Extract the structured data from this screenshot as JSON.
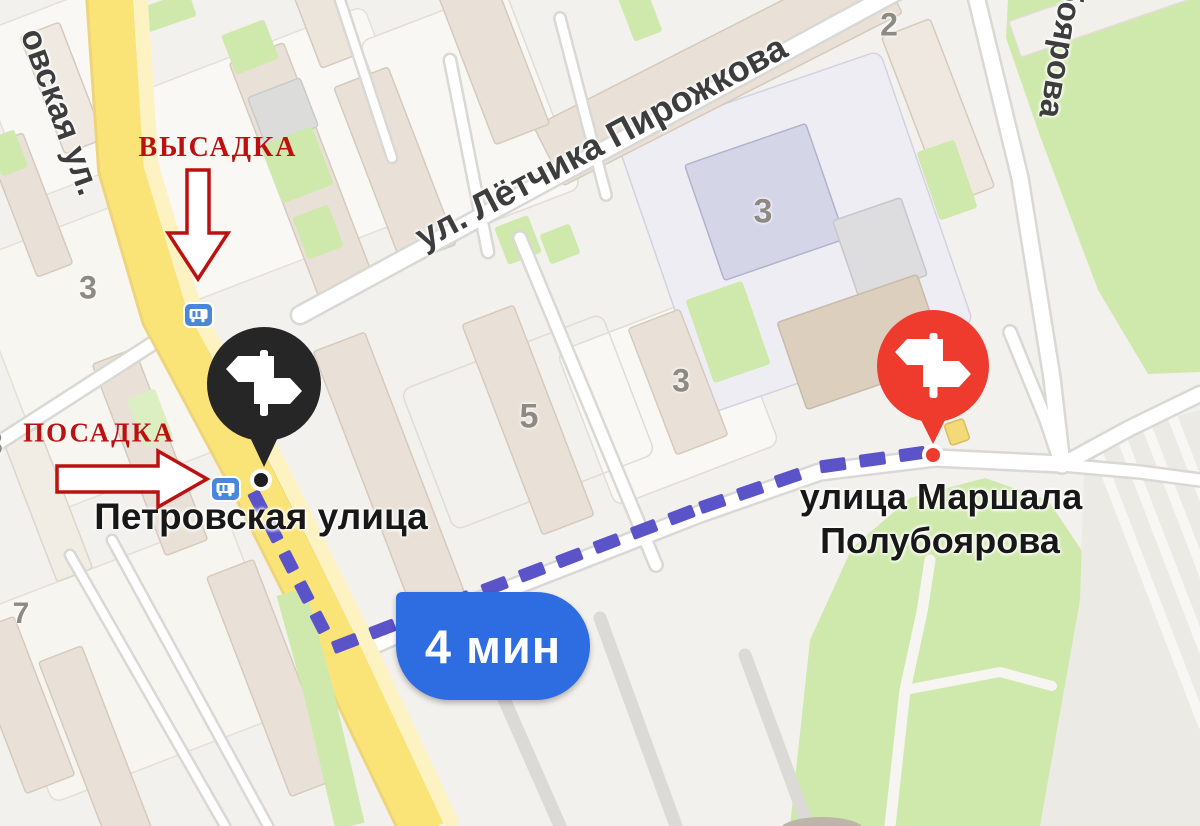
{
  "map": {
    "colors": {
      "background": "#f3f1ed",
      "road_yellow": "#fae478",
      "road_yellow_casing": "#eed47b",
      "sidewalk_cream": "#fdf2c2",
      "park_green": "#cfe9ac",
      "building_beige": "#e9e1d7",
      "bus_stop_blue": "#4b87d9"
    },
    "street_labels": [
      {
        "text": "овская ул."
      },
      {
        "text": "ул. Лётчика Пирожкова"
      },
      {
        "text": "боярова"
      }
    ],
    "place_labels": [
      {
        "text": "Петровская улица"
      },
      {
        "text": "улица Маршала"
      },
      {
        "text": "Полубоярова"
      }
    ],
    "building_numbers": [
      {
        "text": "3"
      },
      {
        "text": "3"
      },
      {
        "text": "5"
      },
      {
        "text": "3"
      },
      {
        "text": "7"
      },
      {
        "text": "2"
      },
      {
        "text": "3"
      }
    ]
  },
  "annotations": {
    "color": "#bb1111",
    "dropoff": {
      "text": "ВЫСАДКА"
    },
    "pickup": {
      "text": "ПОСАДКА"
    }
  },
  "route": {
    "duration_label": "4 мин",
    "badge_color": "#2e6ce2",
    "dash_color": "#5b53c8",
    "segments": [
      {
        "points": [
          [
            253,
            492
          ],
          [
            333,
            648
          ]
        ],
        "dash": 21,
        "gap": 13,
        "width": 13
      },
      {
        "points": [
          [
            333,
            648
          ],
          [
            700,
            508
          ],
          [
            820,
            467
          ],
          [
            926,
            452
          ]
        ],
        "dash": 26,
        "gap": 14,
        "width": 13
      }
    ]
  },
  "markers": {
    "departure": {
      "color": "#262626",
      "dot_color": "#1f1f1f"
    },
    "destination": {
      "color": "#ee3b2e",
      "dot_color": "#ee3b2e"
    }
  }
}
